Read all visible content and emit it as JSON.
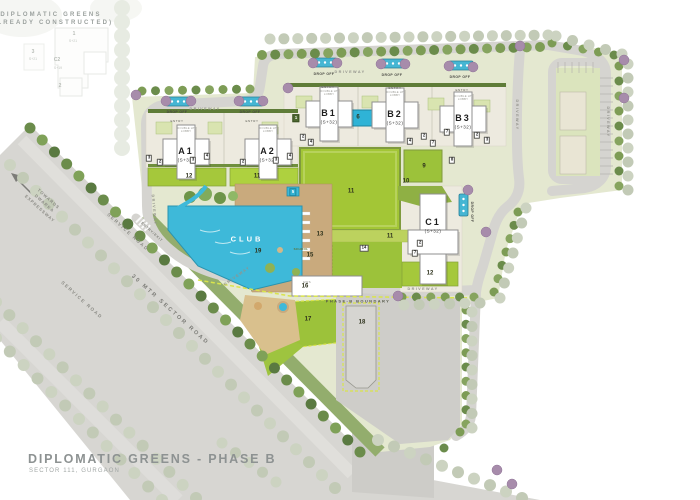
{
  "plan": {
    "constructed": {
      "line1": "DIPLOMATIC GREENS",
      "line2": "(ALREADY CONSTRUCTED)",
      "bldg1_num": "1",
      "bldg1_floors": "S+21",
      "bldg2_num": "C2",
      "bldg2_floors": "S+19",
      "bldg3_num": "2",
      "bldg4_num": "3",
      "bldg4_floors": "S+21"
    },
    "towers": [
      {
        "name": "A1",
        "floors": "(S+32)"
      },
      {
        "name": "A2",
        "floors": "(S+32)"
      },
      {
        "name": "B1",
        "floors": "(S+32)"
      },
      {
        "name": "B2",
        "floors": "(S+32)"
      },
      {
        "name": "B3",
        "floors": "(S+32)"
      },
      {
        "name": "C1",
        "floors": "(S+32)"
      }
    ],
    "lobby_label": "DOUBLE HT LOBBY",
    "club_label": "CLUB",
    "school_label": "SCHOOL",
    "ews_label": "EWS",
    "roads": {
      "drop_off": "DROP OFF",
      "entry": "ENTRY",
      "driveway": "DRIVEWAY",
      "entry_exit": "ENTRY/EXIT",
      "service_road": "SERVICE ROAD",
      "sector_road": "30 MTR SECTOR ROAD",
      "towards": "TOWARDS DWARKA EXPRESSWAY"
    },
    "boundary_label": "PHASE-B BOUNDARY",
    "markers": {
      "plain": [
        {
          "n": "12",
          "x": 189,
          "y": 177
        },
        {
          "n": "11",
          "x": 257,
          "y": 177
        },
        {
          "n": "11",
          "x": 351,
          "y": 192
        },
        {
          "n": "9",
          "x": 424,
          "y": 167
        },
        {
          "n": "10",
          "x": 406,
          "y": 182
        },
        {
          "n": "13",
          "x": 320,
          "y": 235
        },
        {
          "n": "11",
          "x": 390,
          "y": 237
        },
        {
          "n": "12",
          "x": 430,
          "y": 274
        },
        {
          "n": "15",
          "x": 310,
          "y": 256
        },
        {
          "n": "16",
          "x": 305,
          "y": 287
        },
        {
          "n": "17",
          "x": 308,
          "y": 320
        },
        {
          "n": "18",
          "x": 362,
          "y": 323
        },
        {
          "n": "19",
          "x": 258,
          "y": 252
        },
        {
          "n": "6",
          "x": 358,
          "y": 118
        }
      ],
      "boxed": [
        {
          "n": "3",
          "x": 149,
          "y": 158
        },
        {
          "n": "2",
          "x": 160,
          "y": 162
        },
        {
          "n": "3",
          "x": 193,
          "y": 160
        },
        {
          "n": "4",
          "x": 207,
          "y": 156
        },
        {
          "n": "2",
          "x": 243,
          "y": 162
        },
        {
          "n": "3",
          "x": 276,
          "y": 160
        },
        {
          "n": "4",
          "x": 290,
          "y": 156
        },
        {
          "n": "2",
          "x": 303,
          "y": 137
        },
        {
          "n": "4",
          "x": 311,
          "y": 142
        },
        {
          "n": "4",
          "x": 410,
          "y": 141
        },
        {
          "n": "2",
          "x": 424,
          "y": 136
        },
        {
          "n": "7",
          "x": 433,
          "y": 143
        },
        {
          "n": "7",
          "x": 447,
          "y": 132
        },
        {
          "n": "2",
          "x": 477,
          "y": 135
        },
        {
          "n": "3",
          "x": 487,
          "y": 140
        },
        {
          "n": "8",
          "x": 452,
          "y": 160
        },
        {
          "n": "2",
          "x": 420,
          "y": 243
        },
        {
          "n": "7",
          "x": 415,
          "y": 253
        },
        {
          "n": "14",
          "x": 364,
          "y": 248
        }
      ],
      "teal": [
        {
          "n": "5",
          "x": 293,
          "y": 192
        }
      ],
      "dark": [
        {
          "n": "1",
          "x": 296,
          "y": 118
        }
      ]
    },
    "title": "DIPLOMATIC GREENS - PHASE B",
    "subtitle": "SECTOR 111, GURGAON"
  },
  "colors": {
    "water": "#3eb9d9",
    "lawn": "#a3c636",
    "bright_green": "#a5c83b",
    "olive": "#5f7c38",
    "road": "#d5d4d0",
    "deck_wood": "#c9aa7d",
    "purple_tree": "#a78cab",
    "boundary_dash": "#d9e44c"
  }
}
